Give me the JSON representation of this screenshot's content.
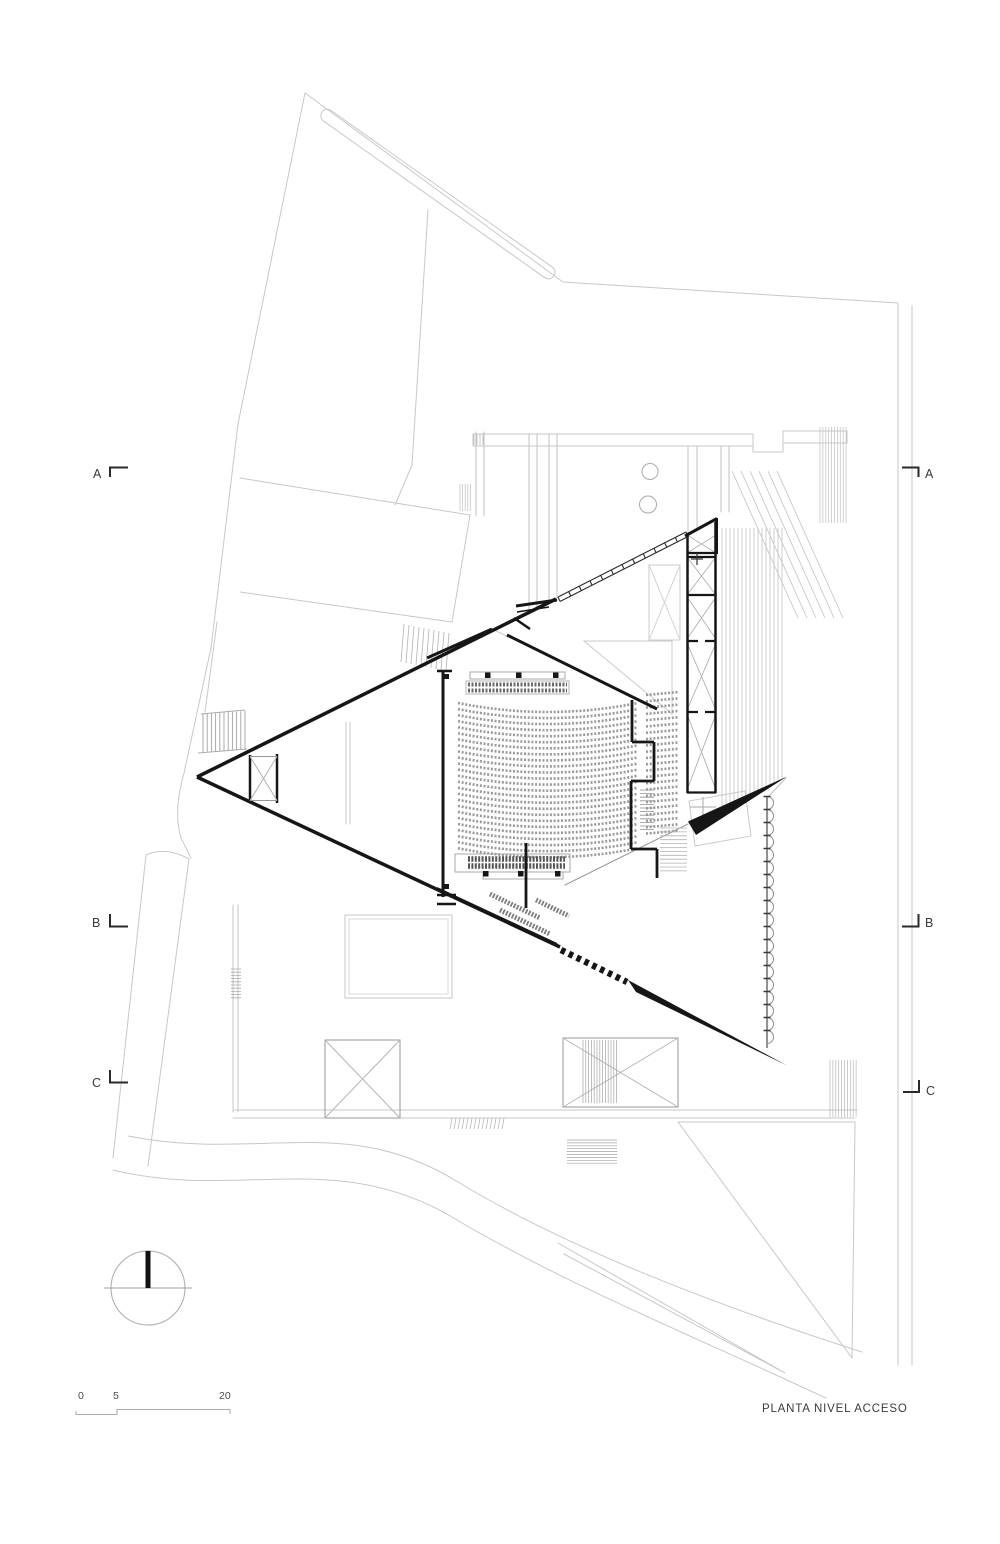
{
  "document": {
    "title": "PLANTA NIVEL ACCESO",
    "type": "architectural floor plan"
  },
  "section_markers": {
    "left": [
      "A",
      "B",
      "C"
    ],
    "right": [
      "A",
      "B",
      "C"
    ]
  },
  "scale_bar": {
    "labels": [
      "0",
      "5",
      "20"
    ]
  },
  "colors": {
    "site_light": "#c6c8ca",
    "medium": "#96989a",
    "ink": "#161616"
  },
  "drawing": {
    "seating": {
      "main_rows": 25,
      "side_rows": 23,
      "row_sag_px": 9
    },
    "facade_doors": 19,
    "stair_ladder_rungs": 13
  }
}
